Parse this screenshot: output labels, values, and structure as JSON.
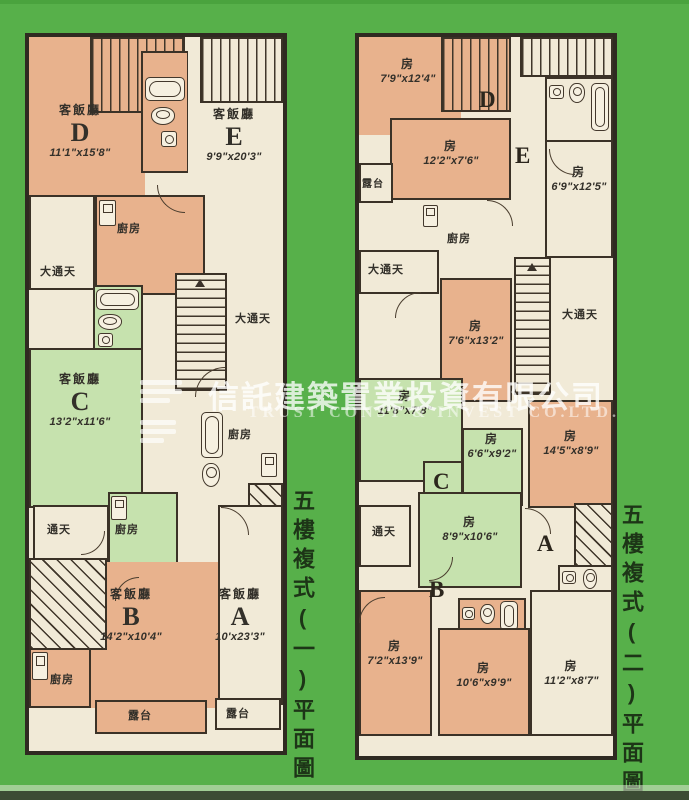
{
  "watermark": {
    "cn": "信託建築置業投資有限公司",
    "en": "TRUST CONST & INVEST CO.LTD."
  },
  "colors": {
    "background_green": "#57b04a",
    "room_tan": "#e8b28d",
    "room_cream": "#f1ead7",
    "room_green": "#c6e2ae",
    "wall": "#2f2a21"
  },
  "plan1": {
    "title": "五樓複式(一)平面圖",
    "rooms": [
      {
        "type": "客飯廳",
        "unit": "D",
        "dim": "11'1\"x15'8\""
      },
      {
        "type": "客飯廳",
        "unit": "E",
        "dim": "9'9\"x20'3\""
      },
      {
        "type": "客飯廳",
        "unit": "C",
        "dim": "13'2\"x11'6\""
      },
      {
        "type": "客飯廳",
        "unit": "B",
        "dim": "14'2\"x10'4\""
      },
      {
        "type": "客飯廳",
        "unit": "A",
        "dim": "10'x23'3\""
      }
    ],
    "labels": {
      "kitchen_top": "廚房",
      "kitchen_mid": "廚房",
      "kitchen_green": "廚房",
      "kitchen_bottom": "廚房",
      "lightwell_left": "大通天",
      "lightwell_right": "大通天",
      "lightwell_small": "通天",
      "balcony_left": "露台",
      "balcony_right": "露台"
    }
  },
  "plan2": {
    "title": "五樓複式(二)平面圖",
    "units": [
      "D",
      "E",
      "C",
      "A",
      "B"
    ],
    "rooms": [
      {
        "type": "房",
        "dim": "7'9\"x12'4\""
      },
      {
        "type": "房",
        "dim": "12'2\"x7'6\""
      },
      {
        "type": "房",
        "dim": "6'9\"x12'5\""
      },
      {
        "type": "房",
        "dim": "7'6\"x13'2\""
      },
      {
        "type": "房",
        "dim": "11'8\"x7'8\""
      },
      {
        "type": "房",
        "dim": "6'6\"x9'2\""
      },
      {
        "type": "房",
        "dim": "14'5\"x8'9\""
      },
      {
        "type": "房",
        "dim": "8'9\"x10'6\""
      },
      {
        "type": "房",
        "dim": "7'2\"x13'9\""
      },
      {
        "type": "房",
        "dim": "10'6\"x9'9\""
      },
      {
        "type": "房",
        "dim": "11'2\"x8'7\""
      }
    ],
    "labels": {
      "balcony": "露台",
      "kitchen": "廚房",
      "lightwell_left": "大通天",
      "lightwell_right": "大通天",
      "lightwell_small": "通天"
    }
  }
}
